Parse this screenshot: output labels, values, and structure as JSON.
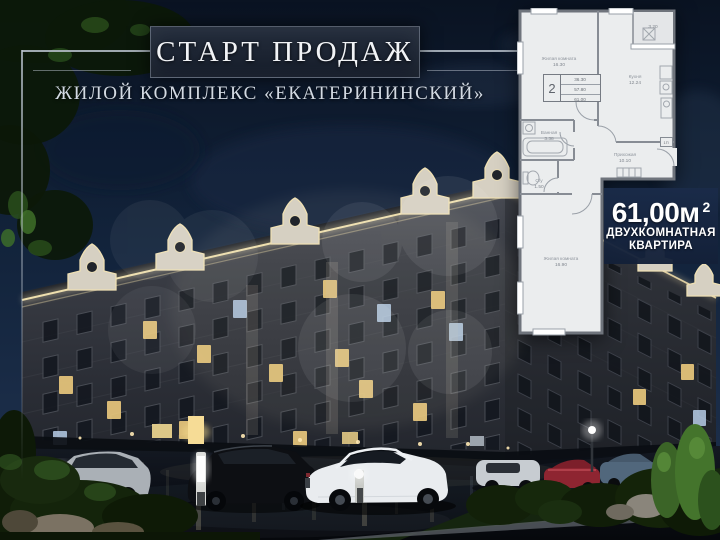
{
  "header": {
    "title": "СТАРТ ПРОДАЖ",
    "subtitle": "ЖИЛОЙ КОМПЛЕКС «ЕКАТЕРИНИНСКИЙ»"
  },
  "floor_plan": {
    "rooms": {
      "living_room_top": {
        "name": "Жилая комната",
        "area": "16.30"
      },
      "kitchen": {
        "name": "Кухня",
        "area": "12.24"
      },
      "bathroom": {
        "name": "Ванная",
        "area": "3.38"
      },
      "hallway": {
        "name": "Прихожая",
        "area": "10.10"
      },
      "wc": {
        "name": "С/у",
        "area": "1.50"
      },
      "living_room_bottom": {
        "name": "Жилая комната",
        "area": "16.90"
      },
      "balcony_area": "3.20"
    },
    "stamp": {
      "room_count": "2",
      "living_area": "36.30",
      "floor_area": "57.80",
      "total_area": "61.00"
    },
    "door_tag": "1П"
  },
  "offer": {
    "area": "61,00м",
    "area_superscript": "2",
    "type_line1": "ДВУХКОМНАТНАЯ",
    "type_line2": "КВАРТИРА"
  },
  "colors": {
    "sky": "#14243c",
    "accent_light": "#ecdcae",
    "plan_background": "#ebedee",
    "offer_background": "#152440",
    "title_color": "#f1f3f6"
  }
}
